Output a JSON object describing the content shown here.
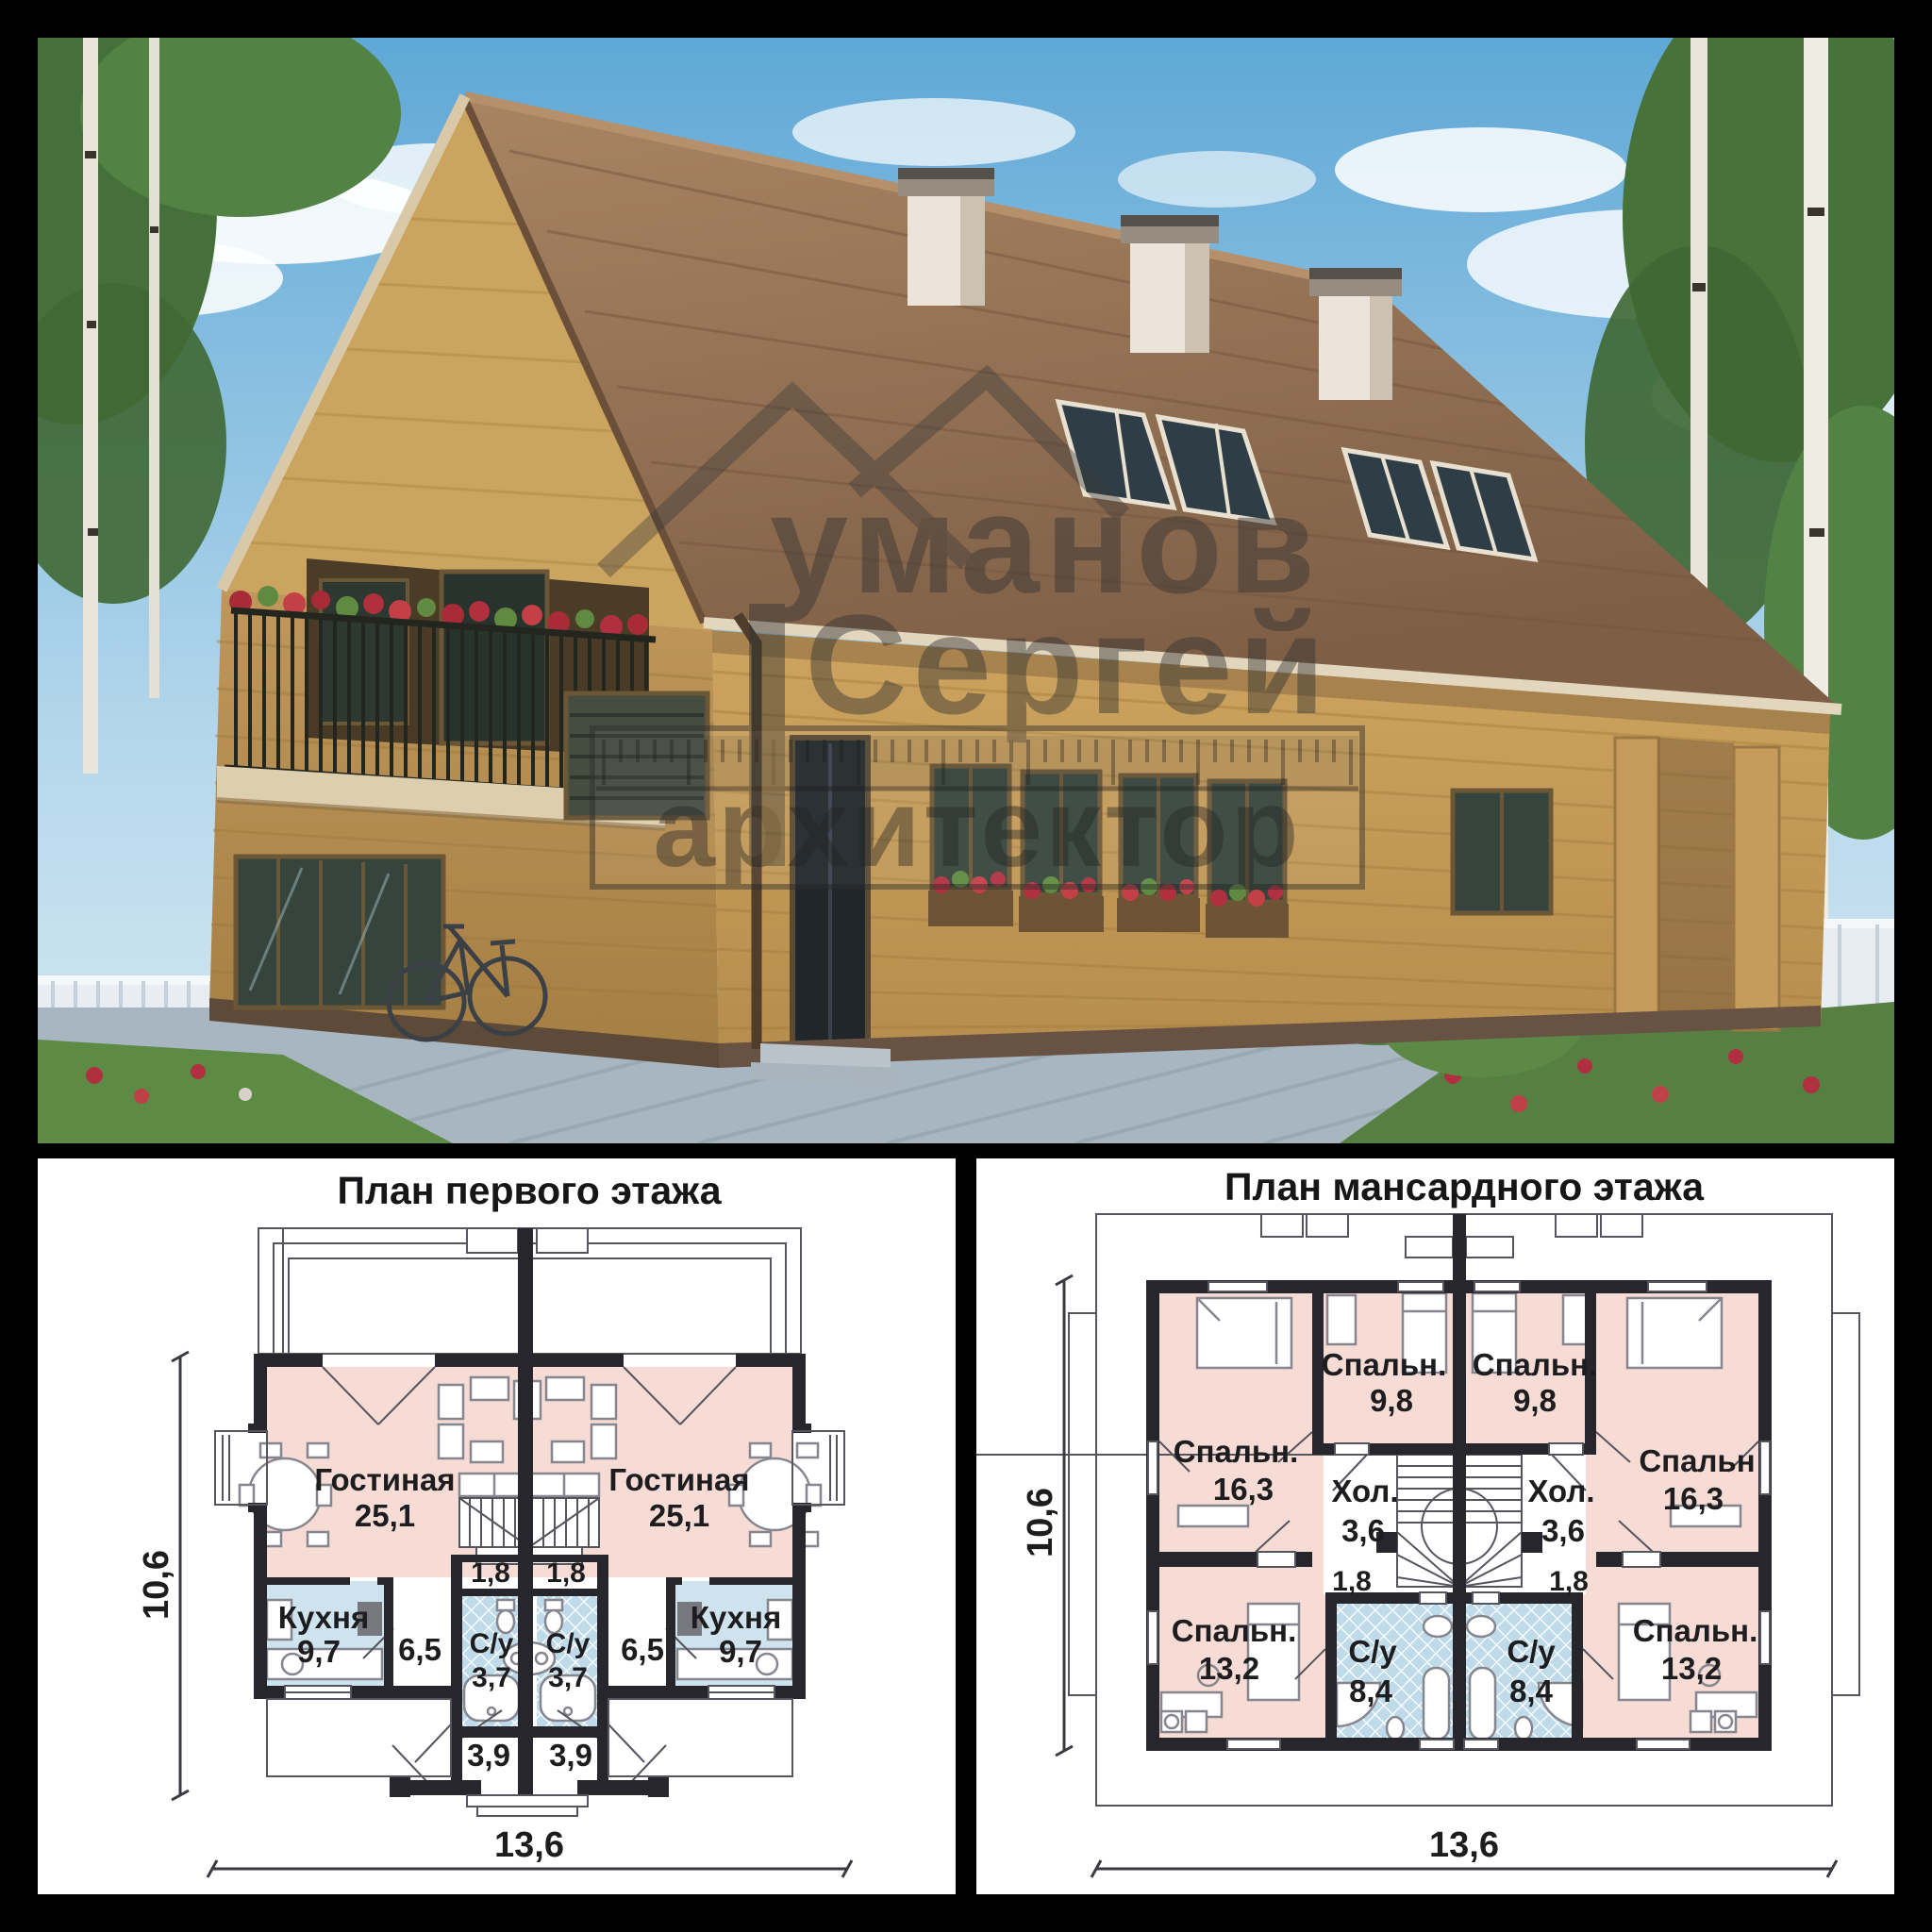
{
  "colors": {
    "frame_background": "#000000",
    "room_pink": "#f7dcd6",
    "kitchen_blue": "#cfe3ee",
    "bath_hatch_blue": "#bfdbe9",
    "wall_dark": "#26262c",
    "sky_blue": "#6fb0dd",
    "roof_brown": "#9572541",
    "wood_tan": "#c49c58"
  },
  "photo": {
    "watermark": {
      "line1": "уманов",
      "line2": "Сергей",
      "line3": "архитектор"
    }
  },
  "first_floor": {
    "title": "План первого этажа",
    "dims": {
      "width": "13,6",
      "height": "10,6"
    },
    "rooms": {
      "living_left": {
        "name": "Гостиная",
        "area": "25,1"
      },
      "living_right": {
        "name": "Гостиная",
        "area": "25,1"
      },
      "kitchen_left": {
        "name": "Кухня",
        "area": "9,7"
      },
      "kitchen_right": {
        "name": "Кухня",
        "area": "9,7"
      },
      "wc_left": {
        "name": "С/у",
        "area": "3,7"
      },
      "wc_right": {
        "name": "С/у",
        "area": "3,7"
      },
      "hall_left": "6,5",
      "hall_right": "6,5",
      "closet_left": "1,8",
      "closet_right": "1,8",
      "entry_left": "3,9",
      "entry_right": "3,9"
    }
  },
  "attic_floor": {
    "title": "План мансардного этажа",
    "dims": {
      "width": "13,6",
      "height": "10,6"
    },
    "rooms": {
      "bedroom_top_left": {
        "name": "Спальн.",
        "area": "9,8"
      },
      "bedroom_top_right": {
        "name": "Спальн.",
        "area": "9,8"
      },
      "bedroom_mid_left": {
        "name": "Спальн.",
        "area": "16,3"
      },
      "bedroom_mid_right": {
        "name": "Спальн",
        "area": "16,3"
      },
      "hall_left": {
        "name": "Хол.",
        "area": "3,6"
      },
      "hall_right": {
        "name": "Хол.",
        "area": "3,6"
      },
      "landing_left": "1,8",
      "landing_right": "1,8",
      "bedroom_bottom_left": {
        "name": "Спальн.",
        "area": "13,2"
      },
      "bedroom_bottom_right": {
        "name": "Спальн.",
        "area": "13,2"
      },
      "wc_left": {
        "name": "С/у",
        "area": "8,4"
      },
      "wc_right": {
        "name": "С/у",
        "area": "8,4"
      }
    }
  }
}
